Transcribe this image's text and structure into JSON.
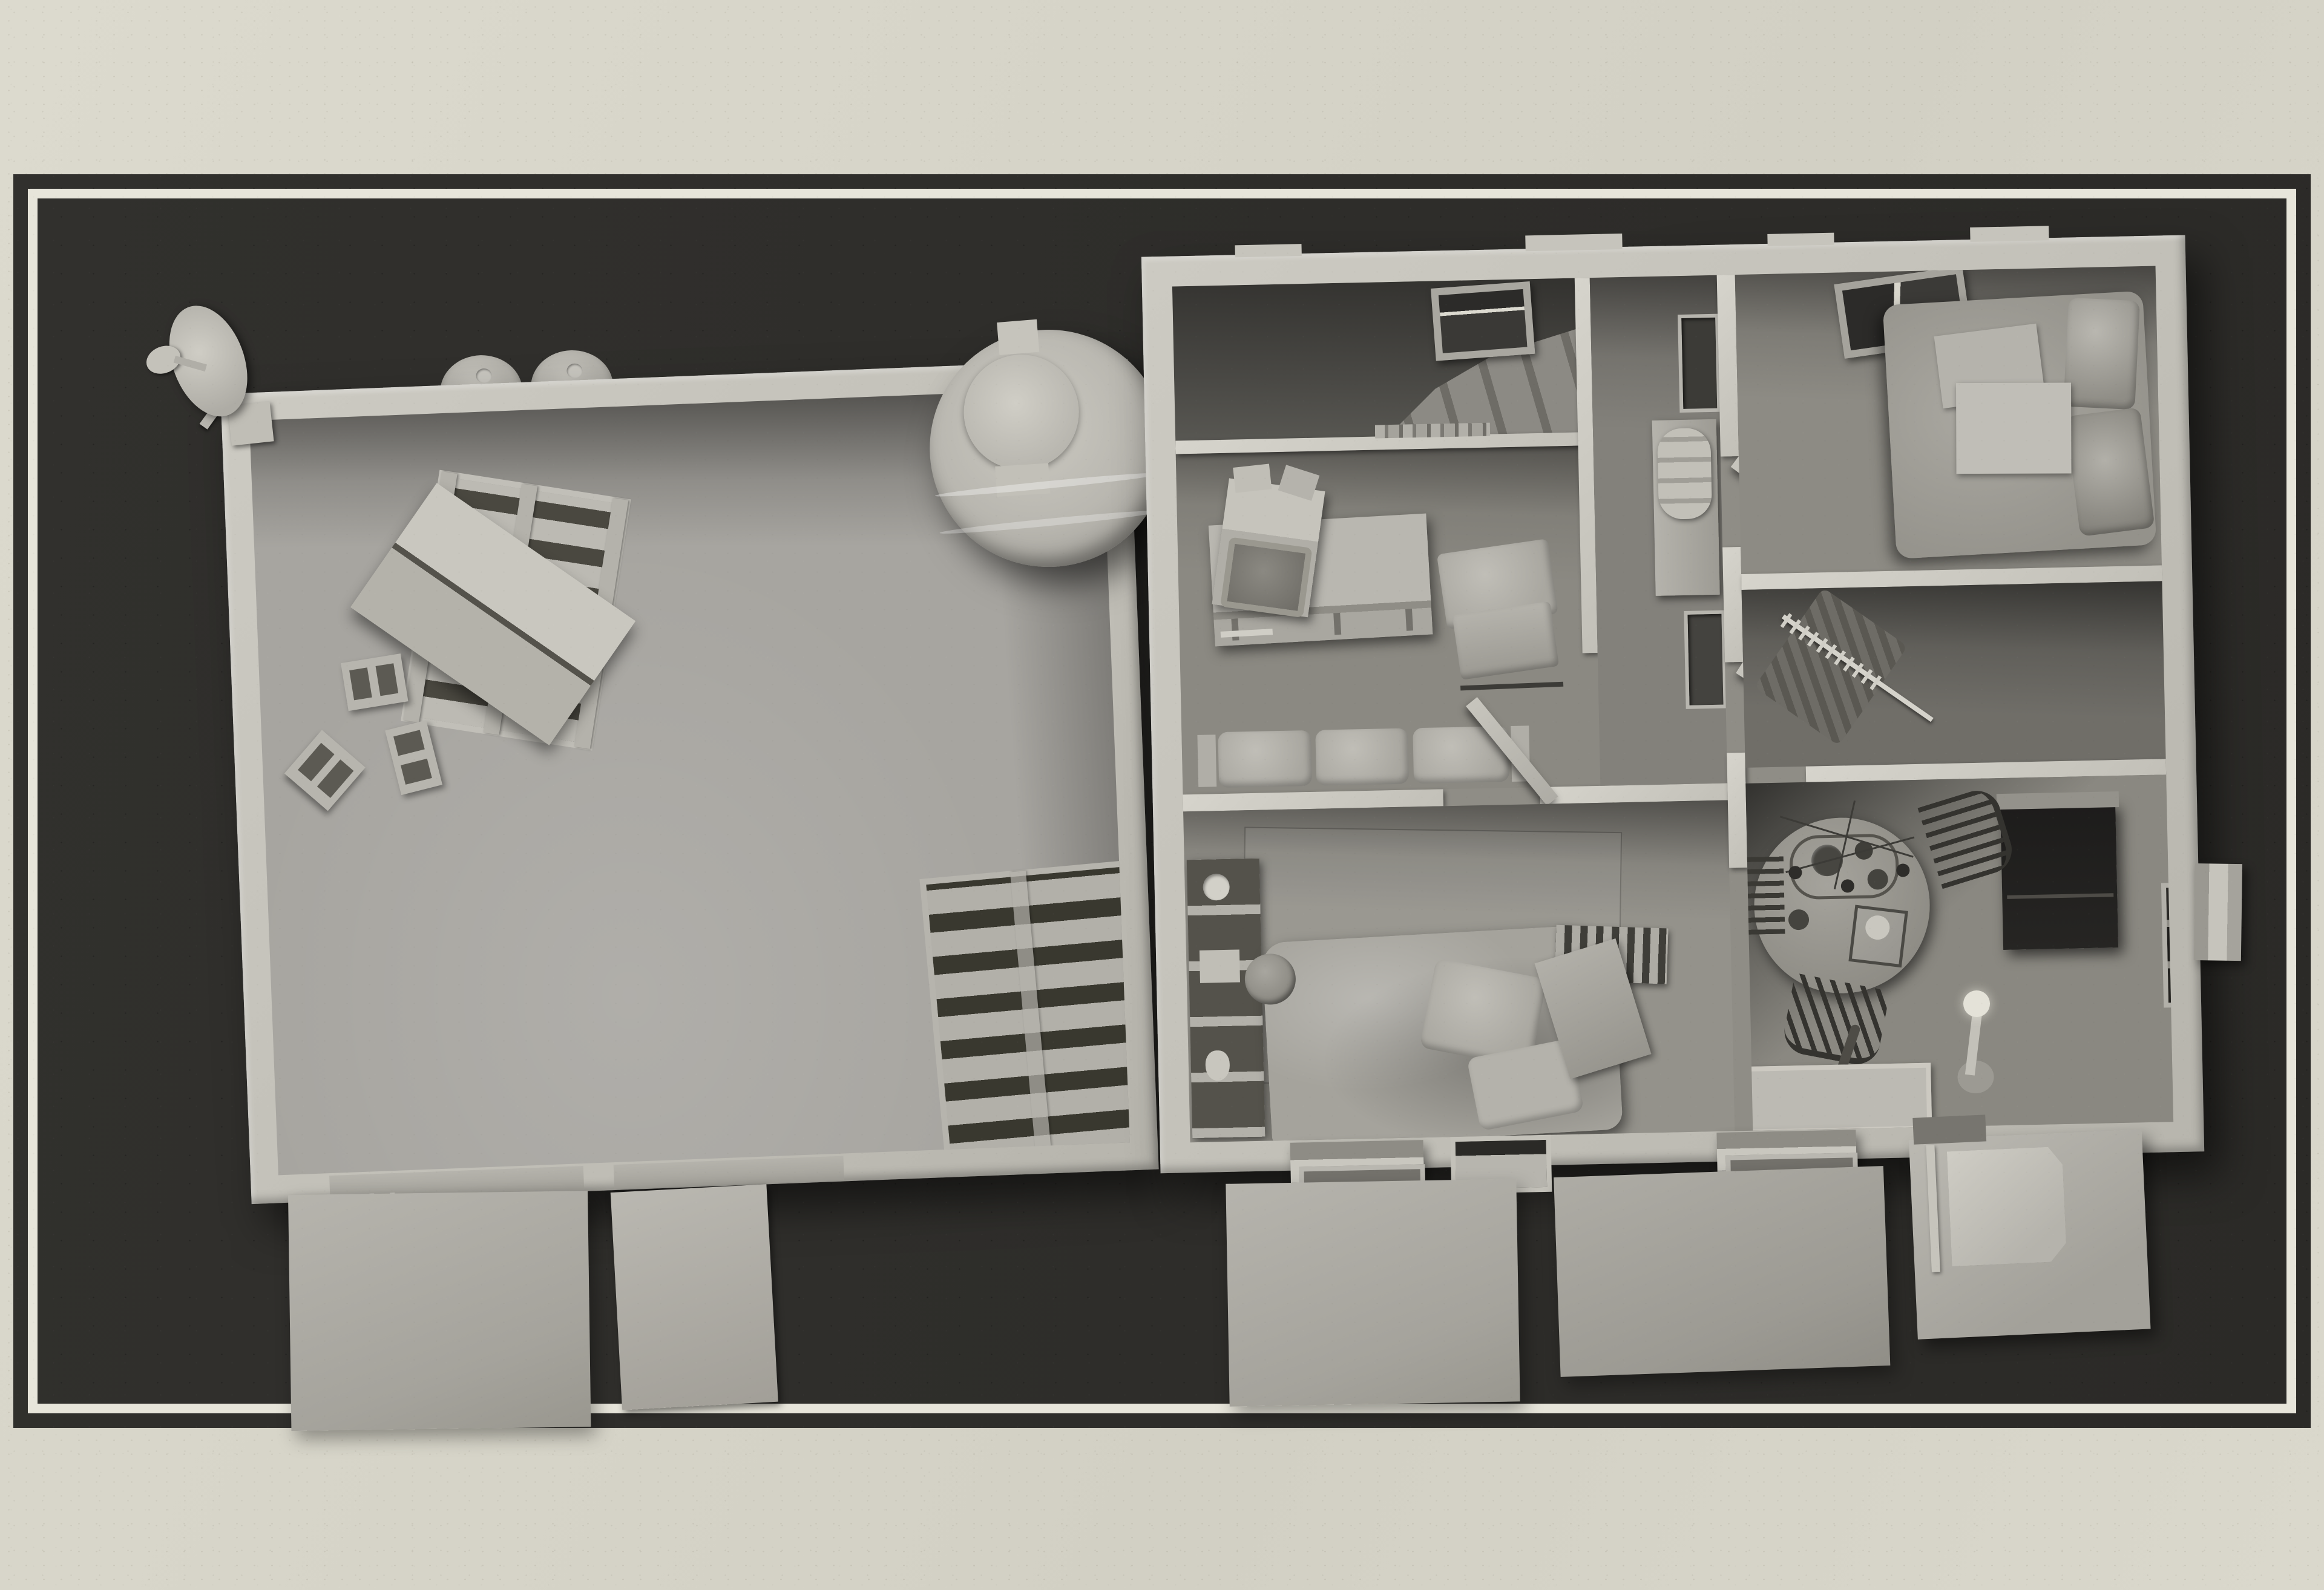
{
  "image": {
    "kind": "3d-architectural-model-render",
    "view": "top-down dollhouse / floor-plan view",
    "style": "monochrome clay render of a compound (warehouse + furnished house) on a dark mat with a light inner border, over textured paper",
    "visible_text": "none"
  },
  "palette": {
    "paper": "#d7d5c9",
    "mat_panel": "#2e2d2a",
    "border_line": "#e7e5da",
    "wall_light": "#c6c4bc",
    "wall_shade": "#9e9c95",
    "floor_warehouse": "#a7a5a0",
    "floor_rooms": "#8f8d86",
    "deep_shadow": "#3f3e3b",
    "dark_furniture": "#232220"
  },
  "labels": {
    "paper_background": "Textured paper background",
    "mat_panel": "Dark presentation mat",
    "border_line": "Light inset border frame",
    "warehouse": "Warehouse / storage hall (left building)",
    "house": "Furnished house (right building)",
    "satellite_dish": "Satellite dish on corner mast",
    "barrels": "Two storage drums behind top wall",
    "water_tank": "Ribbed water storage tank with round lid",
    "pallet_with_box": "Wooden pallet with open cardboard box",
    "cinder_blocks": "Three concrete blocks",
    "leaning_pallet": "Pallet leaning on right wall",
    "ground_mat": "Concrete apron / ground mat",
    "door_ramp": "Door leaf leaning outside",
    "staircase": "Staircase along top wall",
    "skylight": "Roof window",
    "living_room": "Living room",
    "tv_console": "TV sideboard with shelves",
    "crt_tv": "CRT television",
    "armchair": "Armchair",
    "books": "Row of books on half wall",
    "sofa": "Three-seat sofa against wall",
    "corridor": "Hallway with storage niches",
    "dresser": "Hall cabinet with rolled quilt",
    "bedroom": "Main bedroom",
    "bed": "Double bed with pillows and folded duvet",
    "closet": "Walk-in closet",
    "clothes_rail": "Clothes rail with hangers",
    "dining_room": "Dining room",
    "dining_table": "Round dining table with tea set",
    "chandelier": "Wire chandelier above table",
    "chair": "Dining chair",
    "wardrobe": "Dark wardrobe cabinet",
    "floor_lamp": "Floor lamp",
    "kids_room": "Second bedroom",
    "bookshelf": "Bookshelf with clock and boxes",
    "messy_bed": "Unmade bed with crumpled blanket",
    "basketball": "Basketball",
    "radiator": "Radiator",
    "open_door": "Open interior door",
    "entry_tray": "Entry floor tray",
    "umbrella": "Umbrella leaning at entry",
    "window_canopy": "Exterior window canopy",
    "porch": "Entry porch with step unit"
  },
  "buildings": [
    {
      "name": "warehouse",
      "rooms": [
        {
          "name": "storage-hall",
          "objects": [
            "pallet_with_box",
            "cinder_blocks",
            "leaning_pallet"
          ]
        }
      ],
      "exterior": [
        "satellite_dish",
        "barrels",
        "ground_mat",
        "door_ramp"
      ]
    },
    {
      "name": "house",
      "rooms": [
        {
          "name": "living_room",
          "objects": [
            "tv_console",
            "crt_tv",
            "armchair",
            "books",
            "sofa",
            "staircase",
            "skylight"
          ]
        },
        {
          "name": "corridor",
          "objects": [
            "dresser"
          ]
        },
        {
          "name": "bedroom",
          "objects": [
            "bed",
            "skylight",
            "open_door"
          ]
        },
        {
          "name": "closet",
          "objects": [
            "clothes_rail",
            "open_door"
          ]
        },
        {
          "name": "dining_room",
          "objects": [
            "dining_table",
            "chandelier",
            "chair",
            "wardrobe",
            "floor_lamp",
            "entry_tray",
            "umbrella"
          ]
        },
        {
          "name": "kids_room",
          "objects": [
            "bookshelf",
            "messy_bed",
            "basketball",
            "radiator",
            "open_door"
          ]
        }
      ],
      "exterior": [
        "window_canopy",
        "ground_mat",
        "porch",
        "water_tank"
      ]
    }
  ]
}
